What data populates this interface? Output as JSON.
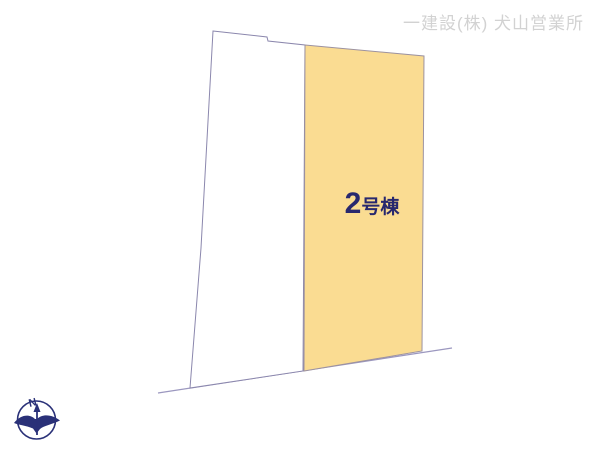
{
  "header": {
    "company_label": "一建設(株) 犬山営業所"
  },
  "plot": {
    "building_label": "2号棟",
    "building_number": "2",
    "building_suffix": "号棟"
  },
  "compass": {
    "north_label": "N"
  },
  "colors": {
    "background": "#FFFFFF",
    "parcel_fill": "#FADC92",
    "parcel_stroke": "#9C92A0",
    "open_parcel_stroke": "#8B87AD",
    "boundary_line": "#9B97BF",
    "label_text": "#28286E",
    "company_text": "#D2D2D2",
    "compass": "#2A3178"
  }
}
